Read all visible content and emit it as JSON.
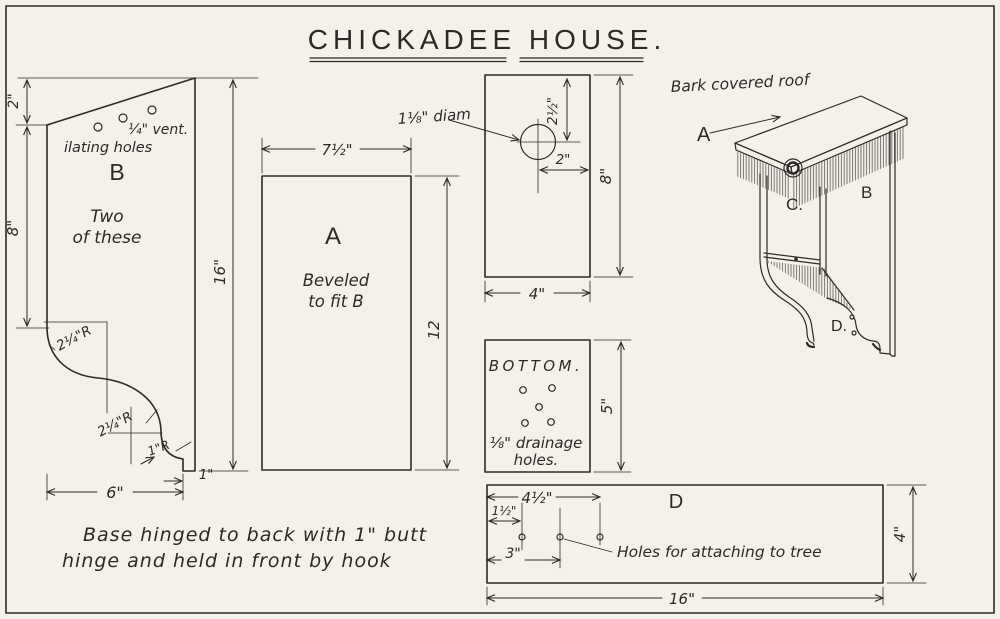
{
  "colors": {
    "paper": "#f3f1ea",
    "ink": "#2c2a27"
  },
  "title": "CHICKADEE HOUSE.",
  "piece_b": {
    "label": "B",
    "vent_note_1": "¼\" vent.",
    "vent_note_2": "ilating holes",
    "qty_note_1": "Two",
    "qty_note_2": "of these",
    "dim_top": "2\"",
    "dim_upper_side": "8\"",
    "dim_height": "16\"",
    "dim_bottom": "6\"",
    "dim_foot": "1\"",
    "radius_upper": "2¼\"R",
    "radius_lower": "2¼\"R",
    "radius_foot": "1\"R"
  },
  "piece_a": {
    "label": "A",
    "bevel_note_1": "Beveled",
    "bevel_note_2": "to fit B",
    "dim_width": "7½\"",
    "dim_height": "12"
  },
  "front_panel": {
    "hole_label": "1⅛\" diam",
    "dim_hole_from_top": "2½\"",
    "dim_hole_from_side": "2\"",
    "dim_height": "8\"",
    "dim_width": "4\""
  },
  "bottom_panel": {
    "label": "BOTTOM.",
    "drain_note_1": "⅛\" drainage",
    "drain_note_2": "holes.",
    "dim_height": "5\""
  },
  "base_panel": {
    "label": "D",
    "dim_hole_far": "4½\"",
    "dim_hole_edge": "1½\"",
    "dim_hole_mid": "3\"",
    "holes_note": "Holes for attaching to tree",
    "dim_length": "16\"",
    "dim_height": "4\""
  },
  "assembly": {
    "roof_note": "Bark covered roof",
    "label_roof": "A",
    "label_side": "B",
    "label_front": "C.",
    "label_base": "D."
  },
  "footnote": {
    "line_1": "Base hinged to back with 1\" butt",
    "line_2": "hinge and held in front by hook"
  }
}
